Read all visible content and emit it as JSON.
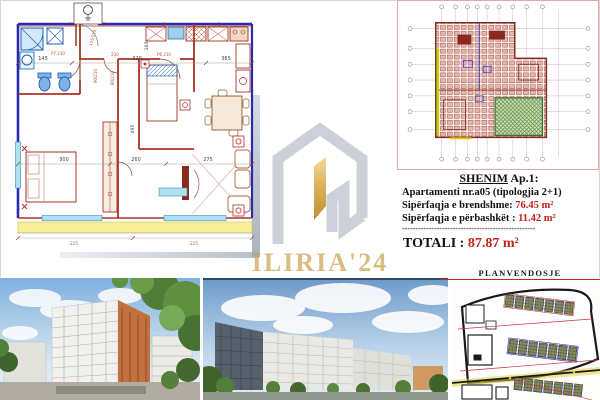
{
  "note": {
    "heading_word": "SHENIM",
    "heading_rest": " Ap.1:",
    "apartment_line": "Apartamenti nr.a05 (tipologjia 2+1)",
    "area_inner_label": "Sipërfaqja e brendshme: ",
    "area_inner_value": "76.45 m²",
    "area_common_label": "Sipërfaqja e përbashkët : ",
    "area_common_value": "11.42 m²",
    "separator": "--------------------------------------------------",
    "total_label": "TOTALI : ",
    "total_value": "87.87 m²"
  },
  "site_plan_label": "PLANVENDOSJE",
  "watermark": {
    "brand": "ILIRIA'24"
  },
  "floor_plan": {
    "dims_top": [
      "145",
      "320",
      "365"
    ],
    "dims_mid": [
      "300",
      "260",
      "275"
    ],
    "dims_vertical": [
      "160",
      "495"
    ],
    "door_labels": [
      "125/215",
      "P7 210",
      "210",
      "P6 210",
      "90/210",
      "80/210"
    ],
    "dims_bottom": [
      "215",
      "215"
    ]
  },
  "colors": {
    "wall_blue": "#2a2ab0",
    "wall_red": "#a93226",
    "window_cyan": "#aee2f0",
    "balcony_yellow": "#f8f097",
    "fixture_blue": "#1f5fae",
    "highlight_green": "#5f8f3f",
    "accent_red": "#c4201a",
    "logo_gold": "#cda75a",
    "logo_gray": "#c6cad3"
  }
}
